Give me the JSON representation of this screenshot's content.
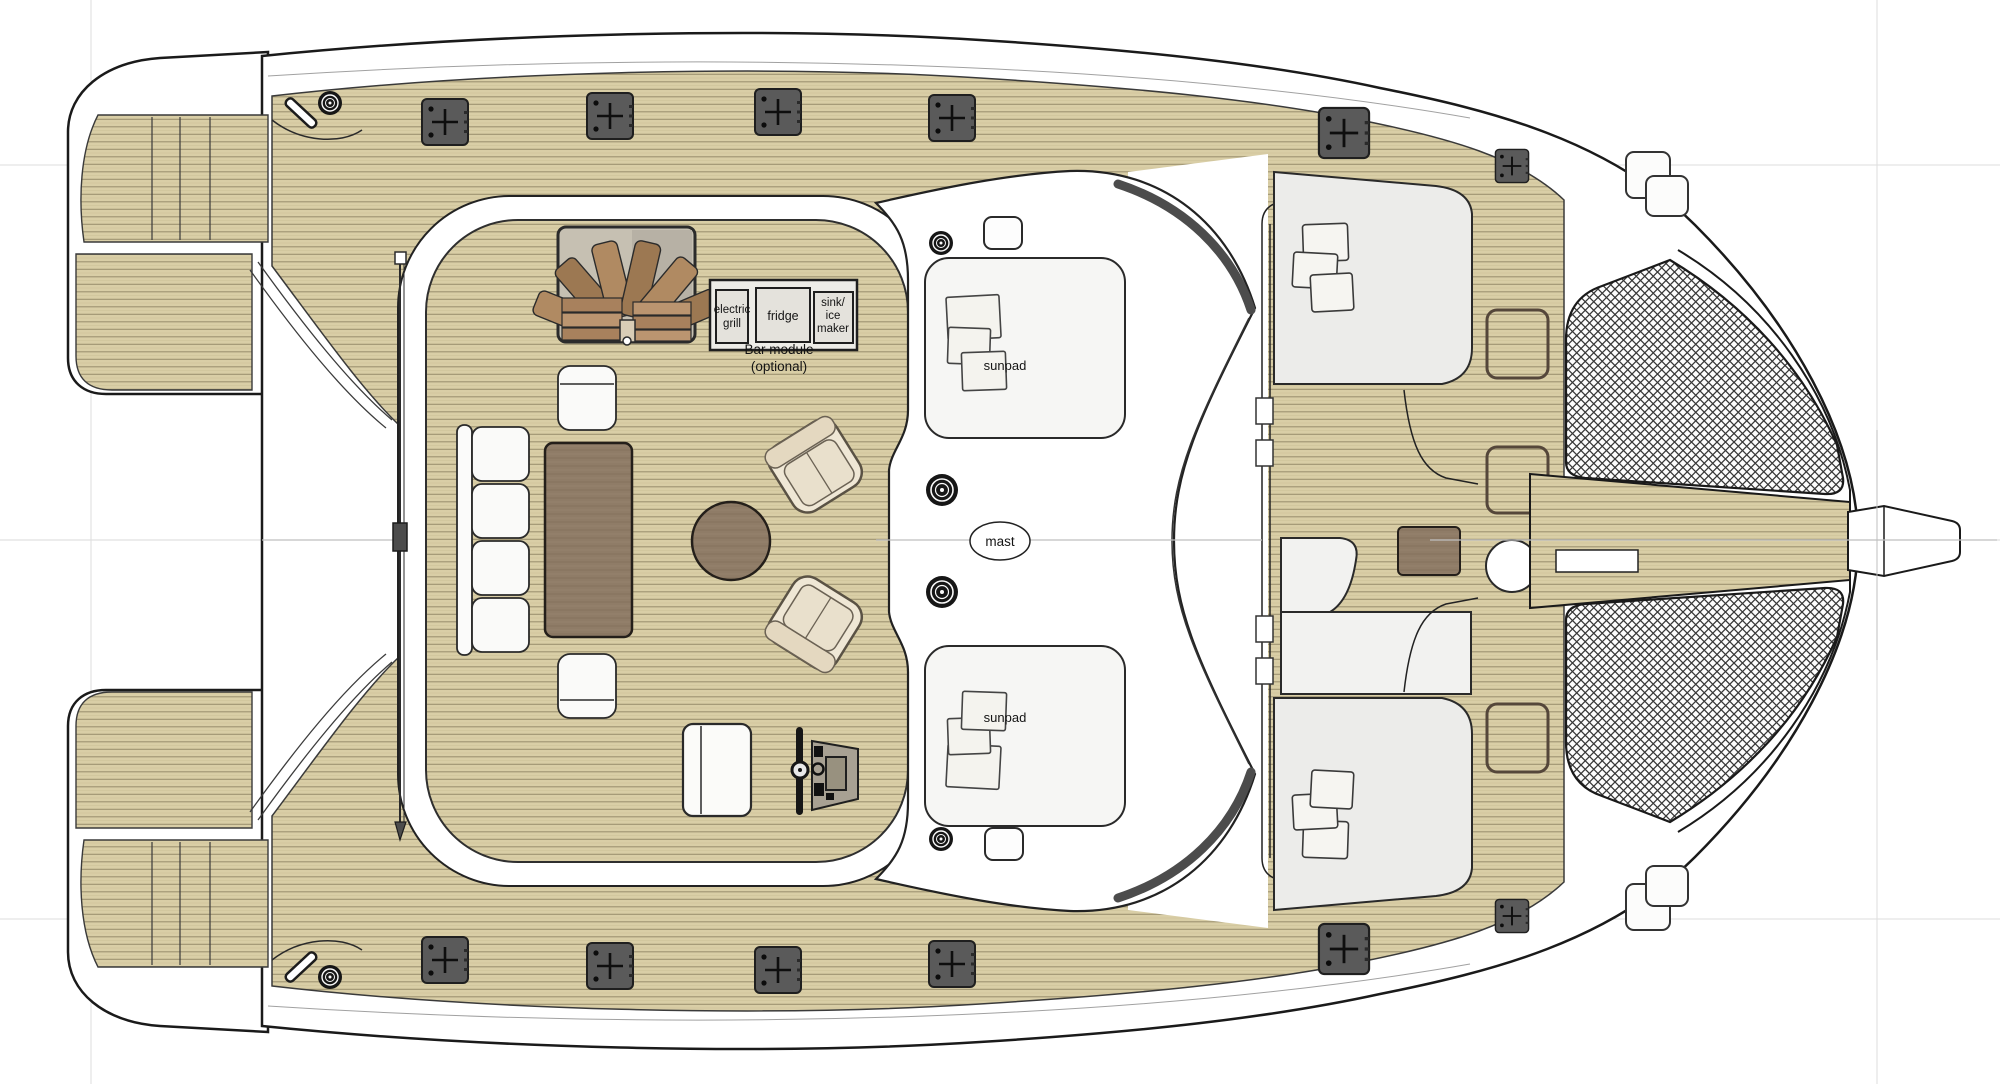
{
  "title": "Catamaran flybridge deck plan",
  "labels": {
    "bar_module": {
      "grill_line1": "electric",
      "grill_line2": "grill",
      "fridge": "fridge",
      "sink_line1": "sink/",
      "sink_line2": "ice",
      "sink_line3": "maker",
      "caption_line1": "Bar module",
      "caption_line2": "(optional)"
    },
    "sunpad_top": "sunpad",
    "sunpad_bottom": "sunpad",
    "mast": "mast"
  },
  "palette": {
    "deck_wood": "#d9cea6",
    "plank_line": "#9d9270",
    "table_wood": "#8f7c67",
    "hull_white": "#ffffff",
    "hatch_gray": "#5a5a5a",
    "outline": "#1d1d1d",
    "cushion_beige": "#efe7d5",
    "seat_white": "#fafaf8",
    "mesh_line": "#383838",
    "centerline_gray": "#bfbfbf"
  }
}
